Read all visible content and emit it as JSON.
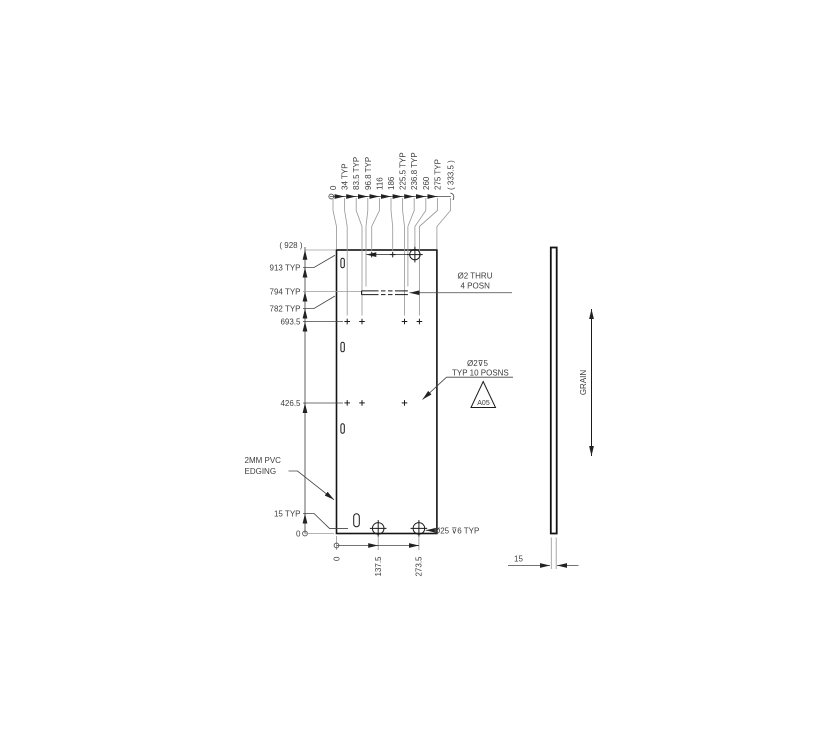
{
  "drawing_title": "panel-drilling-drawing",
  "top_dims": [
    "0",
    "34 TYP",
    "83.5 TYP",
    "96.8 TYP",
    "116",
    "186",
    "225.5 TYP",
    "236.8 TYP",
    "260",
    "275 TYP",
    "( 333.5 )"
  ],
  "left_dims": [
    "( 928 )",
    "913 TYP",
    "794 TYP",
    "782 TYP",
    "693.5",
    "426.5",
    "15 TYP",
    "0"
  ],
  "bottom_dims": [
    "0",
    "137.5",
    "273.5"
  ],
  "notes": {
    "thru_hole_line1": "Ø2 THRU",
    "thru_hole_line2": "4 POSN",
    "blind_hole_line1": "Ø2⊽5",
    "blind_hole_line2": "TYP 10 POSNS",
    "edging_line1": "2MM PVC",
    "edging_line2": "EDGING",
    "big_hole_note": "Ø25 ⊽6 TYP",
    "flag_label": "A05",
    "grain_label": "GRAIN",
    "thickness_dim": "15"
  },
  "colors": {
    "object_line": "#1b1b1b",
    "dimension_line": "#454545",
    "extension_line": "#9b9b9b",
    "text": "#3d3d3d",
    "background": "#ffffff"
  }
}
